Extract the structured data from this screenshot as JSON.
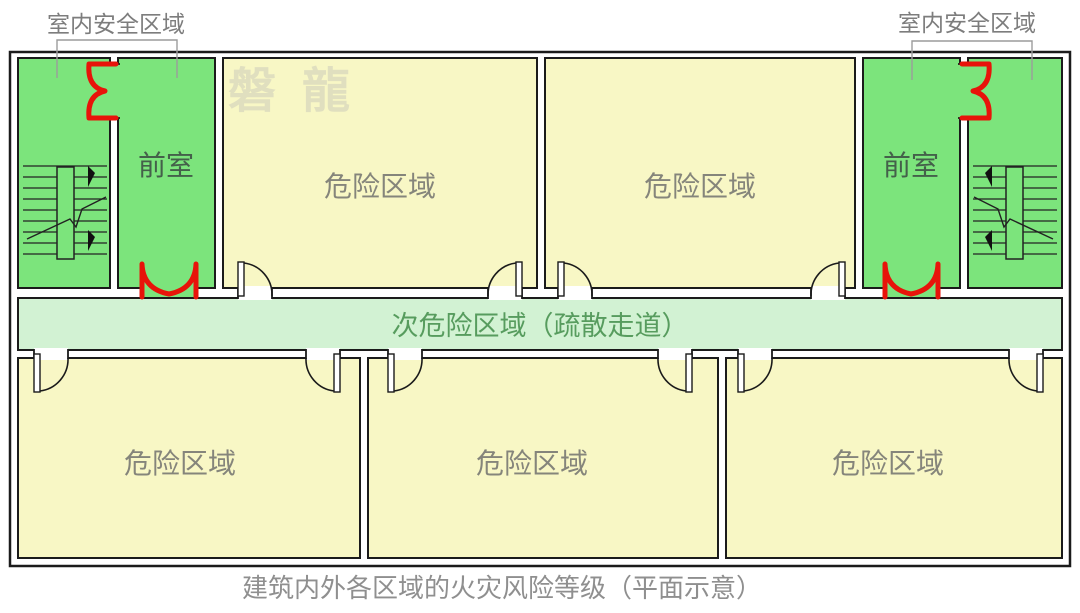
{
  "plan": {
    "caption": "建筑内外各区域的火灾风险等级（平面示意）",
    "watermark": "磐龍",
    "annotations": {
      "left_safe_area": "室内安全区域",
      "right_safe_area": "室内安全区域"
    },
    "rooms": {
      "front_left": "前室",
      "front_right": "前室",
      "corridor": "次危险区域（疏散走道）",
      "danger": [
        "危险区域",
        "危险区域",
        "危险区域",
        "危险区域",
        "危险区域"
      ]
    }
  },
  "colors": {
    "safe_green": "#7ce47c",
    "danger_yellow": "#f8f7c5",
    "corridor_green": "#d2f2d3",
    "fire_door_red": "#e8130a",
    "wall": "#1b1b1b",
    "annotation_gray": "#7d7d7d",
    "caption_gray": "#8f8f8f"
  }
}
